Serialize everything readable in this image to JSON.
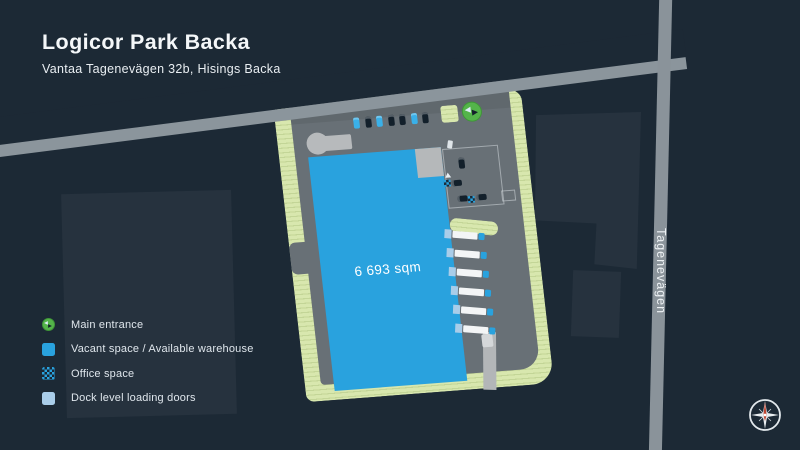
{
  "header": {
    "title": "Logicor Park Backa",
    "subtitle": "Vantaa Tagenevägen 32b, Hisings Backa"
  },
  "map": {
    "area_label": "6 693 sqm",
    "road_label": "Tagenevägen",
    "parking_row_cars": [
      "blue",
      "dark",
      "blue",
      "dark",
      "dark",
      "blue",
      "dark"
    ],
    "dock_truck_count": 6,
    "yard_cars": [
      "dark",
      "dark",
      "dark",
      "dark"
    ],
    "office_marker_count": 2
  },
  "legend": {
    "items": [
      {
        "icon": "main-entrance-icon",
        "label": "Main entrance"
      },
      {
        "icon": "vacant-space-icon",
        "label": "Vacant space / Available warehouse"
      },
      {
        "icon": "office-space-icon",
        "label": "Office space"
      },
      {
        "icon": "dock-doors-icon",
        "label": "Dock level loading doors"
      }
    ]
  },
  "colors": {
    "background": "#1c2935",
    "vacant_blue": "#29a2de",
    "dock_door_blue": "#a9cde9",
    "landscape_green": "#d8e7ae",
    "entrance_green": "#54b44a",
    "asphalt_gray": "#687076",
    "road_gray": "#8b959c",
    "car_blue": "#3ab0e8",
    "car_dark": "#13202b"
  }
}
